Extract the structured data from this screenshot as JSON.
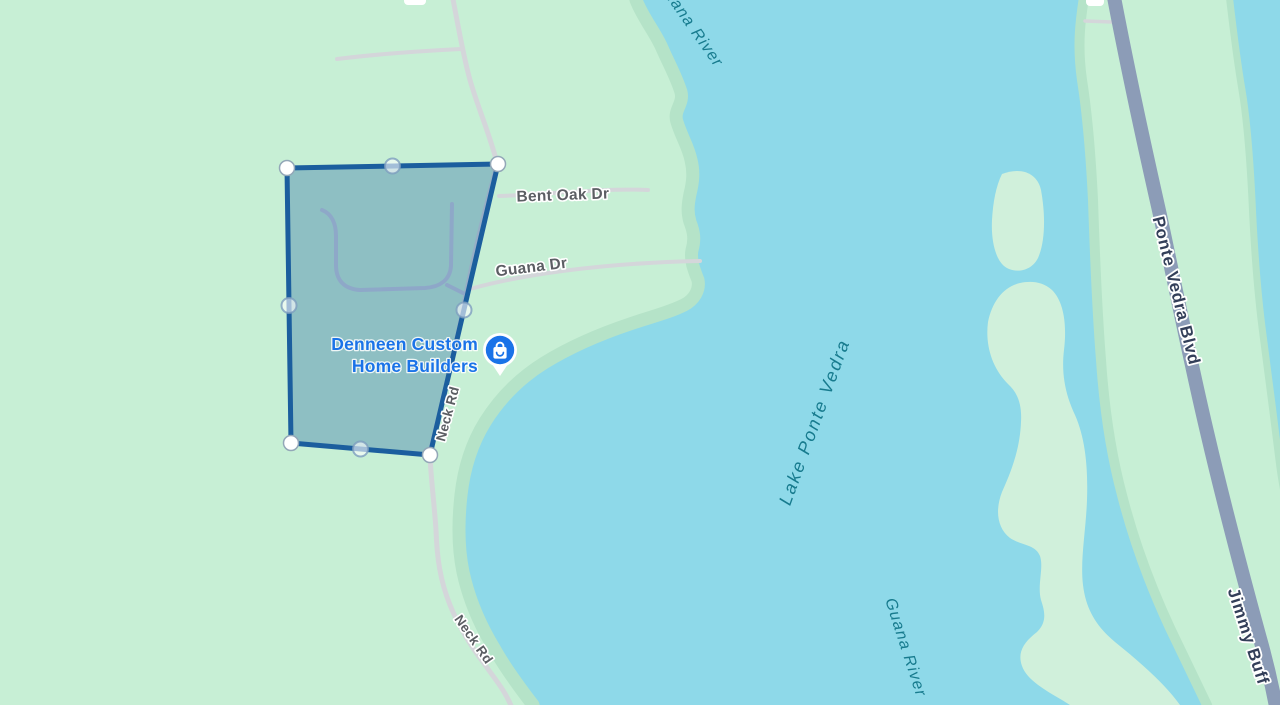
{
  "map": {
    "labels": {
      "guana_river_top": "Guana River",
      "bent_oak_dr": "Bent Oak Dr",
      "guana_dr": "Guana Dr",
      "business": {
        "line1": "Denneen Custom",
        "line2": "Home Builders"
      },
      "neck_rd_upper": "Neck Rd",
      "neck_rd_lower": "Neck Rd",
      "lake": "Lake Ponte Vedra",
      "guana_river_bottom": "Guana River",
      "ponte_vedra_blvd": "Ponte Vedra Blvd",
      "jimmy_buffett_hwy": "Jimmy Buff"
    },
    "icons": {
      "business_pin": "shopping-bag-icon"
    },
    "colors": {
      "water": "#8ed9e9",
      "land": "#c7efd5",
      "shore_band": "#b5e3c8",
      "island": "#d0f0db",
      "minor_road": "#d4d6da",
      "major_road": "#8c9cb7",
      "road_label": "#5b5e63",
      "highway_label": "#333f59",
      "water_label": "#177b8e",
      "business_blue": "#1a73e8",
      "parcel_stroke": "#1b5e9e",
      "parcel_fill": "rgba(27,94,158,0.33)"
    }
  }
}
